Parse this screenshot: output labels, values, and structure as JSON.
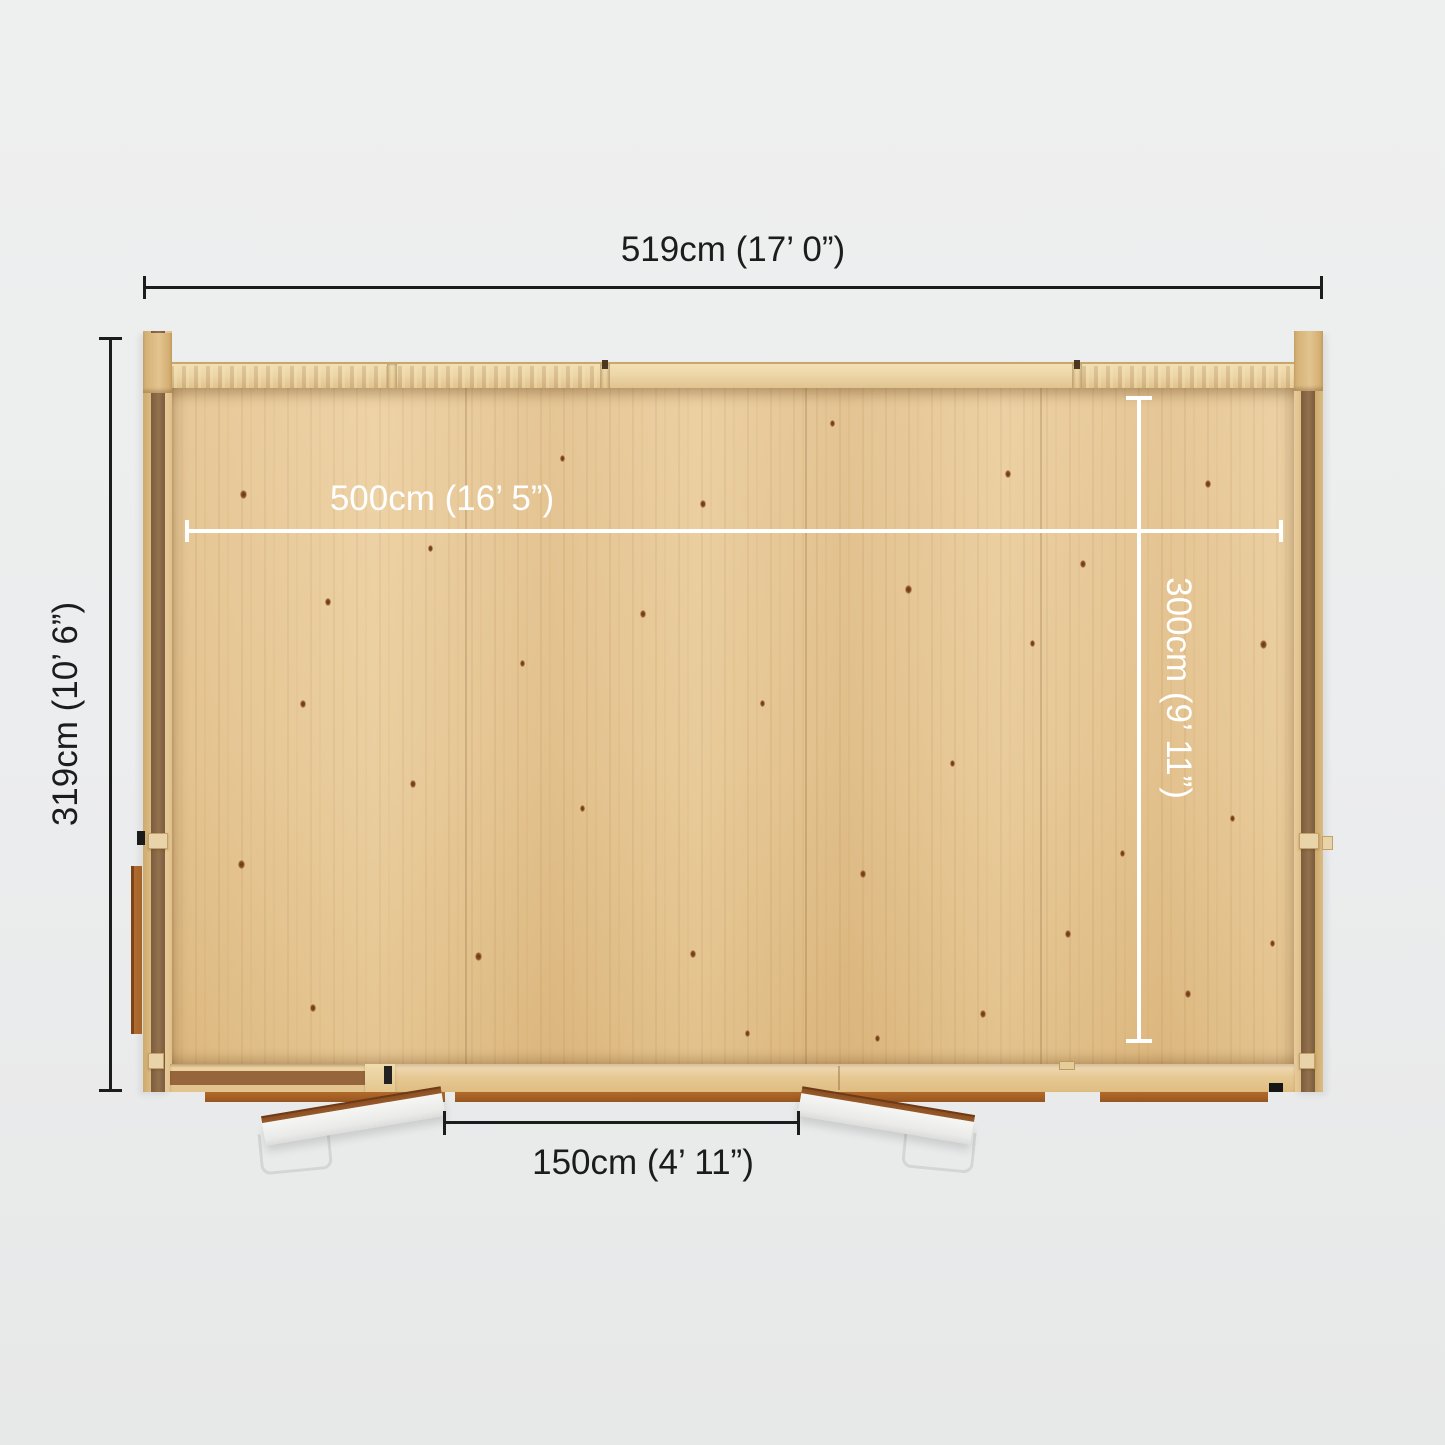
{
  "dimensions": {
    "overall_width": {
      "label": "519cm (17’ 0”)"
    },
    "overall_depth": {
      "label": "319cm (10’ 6”)"
    },
    "internal_width": {
      "label": "500cm (16’ 5”)"
    },
    "internal_depth": {
      "label": "300cm (9’ 11”)"
    },
    "door_opening_width": {
      "label": "150cm (4’ 11”)"
    }
  },
  "colors": {
    "background": "#ecedee",
    "dim_dark": "#1c1c1c",
    "dim_light": "#ffffff",
    "floor_wood": "#e6c795",
    "wall_top_wood": "#ecd4a6",
    "wall_side_wood": "#d5b176",
    "wall_cavity": "#8a6747",
    "tie_wood": "#e9d4a9",
    "sill_orange": "#aa6327",
    "side_door_brown": "#b06c2f",
    "door_panel_white": "#f3f3f2",
    "door_edge_brown": "#8a4e22",
    "handle_grey": "#d4d5d5",
    "hardware_dark": "#1b1b1b"
  }
}
